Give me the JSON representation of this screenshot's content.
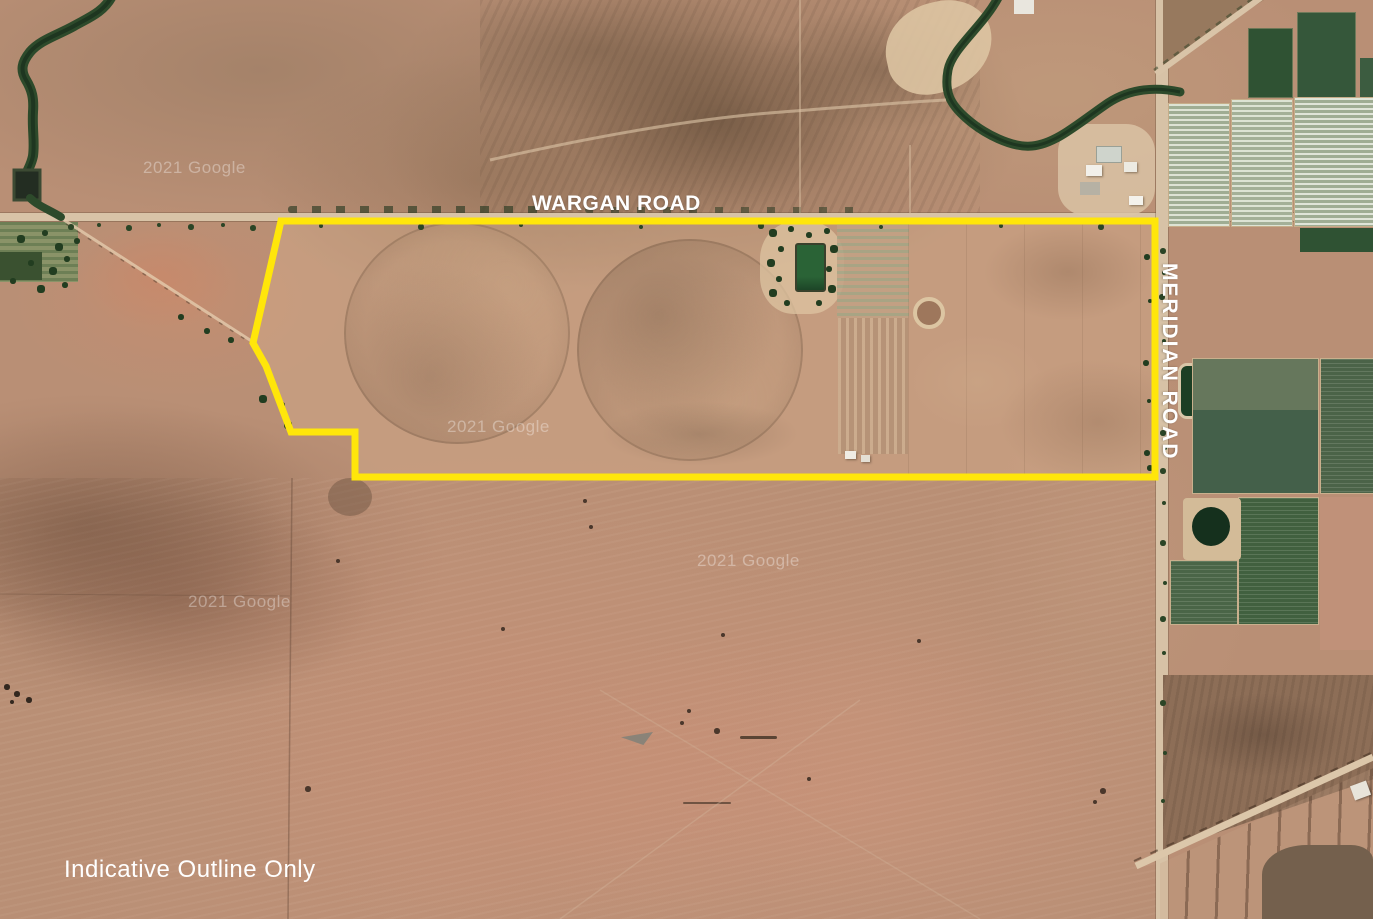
{
  "map": {
    "type": "satellite-aerial-property-map",
    "road_label_top": "WARGAN ROAD",
    "road_label_right": "MERIDIAN ROAD",
    "disclaimer": "Indicative Outline Only",
    "watermark": "2021 Google",
    "outline": {
      "label": "property-boundary-indicative",
      "color": "#FFE60A",
      "stroke_width": 7,
      "points": "281,221 1155,221 1155,477 355,477 355,432 291,432 266,366 253,343"
    },
    "palette": {
      "terrain_base": "#B98F75",
      "road": "#D8C3A7",
      "crop_green_dark": "#2F5233",
      "crop_sage_light": "#DDE3D4",
      "water_dark": "#16301D",
      "label_text": "#FFFFFF"
    }
  }
}
